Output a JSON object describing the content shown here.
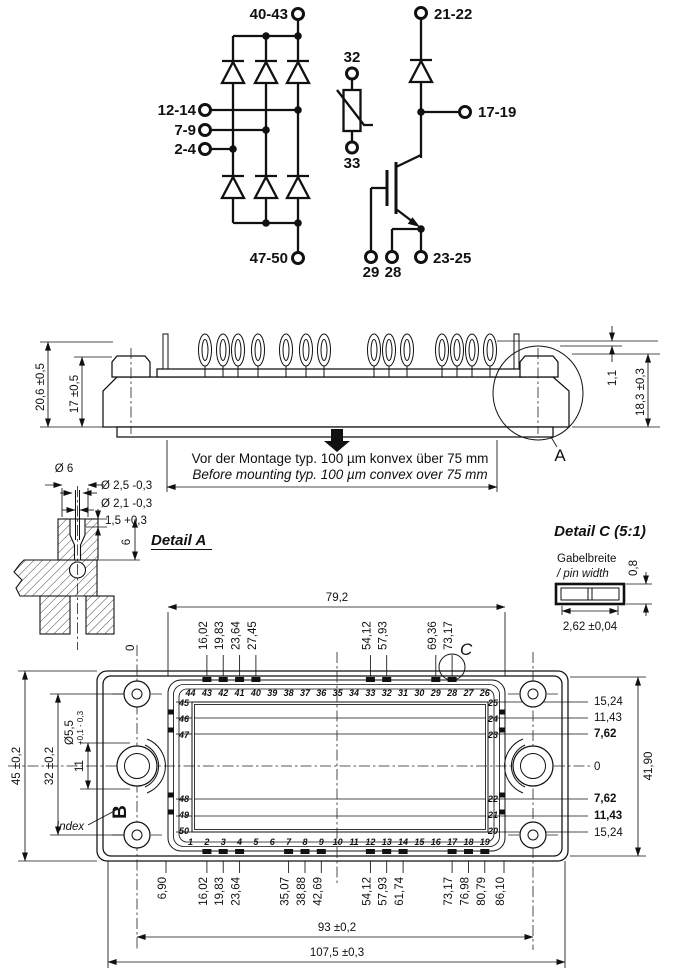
{
  "schematic": {
    "rect_top": "40-43",
    "rect_bottom": "47-50",
    "phases": [
      "12-14",
      "7-9",
      "2-4"
    ],
    "ntc_top": "32",
    "ntc_bottom": "33",
    "igbt_top": "21-22",
    "igbt_out": "17-19",
    "igbt_gate": "29",
    "igbt_aux": "28",
    "igbt_emitter": "23-25"
  },
  "side_view": {
    "dim_total": "20,6 ±0,5",
    "dim_body": "17 ±0,5",
    "dim_pin": "1,1",
    "dim_right": "18,3 ±0,3",
    "detail_ref": "A",
    "note_de": "Vor der Montage typ. 100 µm konvex über 75 mm",
    "note_en": "Before mounting typ. 100 µm convex over 75 mm"
  },
  "detail_a": {
    "title": "Detail A",
    "dims": [
      "Ø 6",
      "Ø 2,5 -0,3",
      "Ø 2,1 -0,3",
      "1,5 +0,3",
      "6"
    ]
  },
  "detail_c": {
    "title": "Detail C (5:1)",
    "label_de": "Gabelbreite",
    "label_en": "/ pin width",
    "dim_height": "0,8",
    "dim_width": "2,62 ±0,04"
  },
  "top_view": {
    "dim_pin_field": "79,2",
    "zero_top": "0",
    "top_offsets": [
      "16,02",
      "19,83",
      "23,64",
      "27,45",
      "54,12",
      "57,93",
      "69,36",
      "73,17"
    ],
    "bottom_offsets": [
      "6,90",
      "16,02",
      "19,83",
      "23,64",
      "35,07",
      "38,88",
      "42,69",
      "54,12",
      "57,93",
      "61,74",
      "73,17",
      "76,98",
      "80,79",
      "86,10"
    ],
    "right_offsets": [
      "15,24",
      "11,43",
      "7,62",
      "0",
      "7,62",
      "11,43",
      "15,24"
    ],
    "dim_height": "41,90",
    "dim_outer": "45 ±0,2",
    "dim_inner": "32 ±0,2",
    "dim_hole_span": "11",
    "hole_dia": "Ø5,5",
    "hole_tol": "+0,1 - 0,3",
    "index_label": "Index",
    "section_ref": "B",
    "detail_ref": "C",
    "pins_top": [
      "44",
      "43",
      "42",
      "41",
      "40",
      "39",
      "38",
      "37",
      "36",
      "35",
      "34",
      "33",
      "32",
      "31",
      "30",
      "29",
      "28",
      "27",
      "26"
    ],
    "pins_bottom": [
      "1",
      "2",
      "3",
      "4",
      "5",
      "6",
      "7",
      "8",
      "9",
      "10",
      "11",
      "12",
      "13",
      "14",
      "15",
      "16",
      "17",
      "18",
      "19"
    ],
    "pins_left": [
      "45",
      "46",
      "47",
      "48",
      "49",
      "50"
    ],
    "pins_right": [
      "25",
      "24",
      "23",
      "22",
      "21",
      "20"
    ],
    "dim_mount": "93 ±0,2",
    "dim_total": "107,5 ±0,3"
  }
}
